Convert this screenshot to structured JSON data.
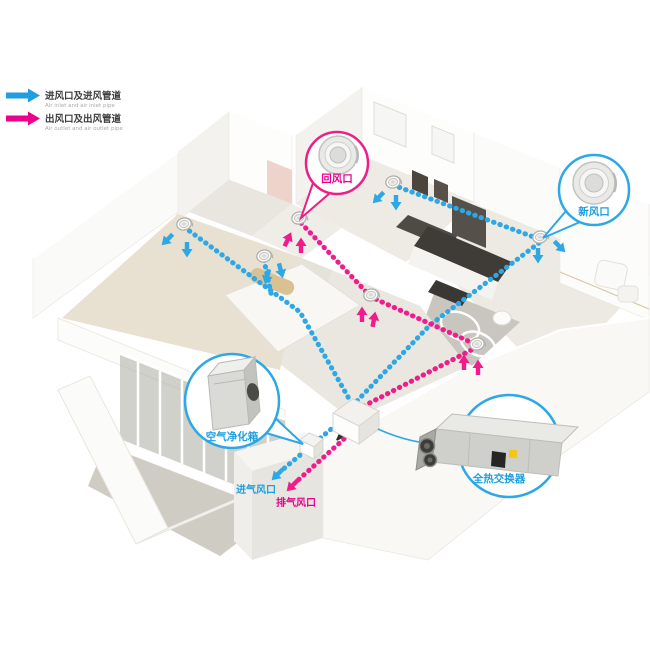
{
  "legend": {
    "inlet": {
      "cn": "进风口及进风管道",
      "en": "Air inlet and air inlet pipe"
    },
    "outlet": {
      "cn": "出风口及出风管道",
      "en": "Air outlet and air outlet pipe"
    }
  },
  "callouts": {
    "return_air": "回风口",
    "fresh_air": "新风口",
    "air_purifier": "空气净化箱",
    "heat_exchanger": "全热交换器"
  },
  "wall_vents": {
    "intake": "进气风口",
    "exhaust": "排气风口"
  },
  "colors": {
    "pipe_blue": "#2da7e5",
    "pipe_pink": "#ee1d8b",
    "label_blue": "#1e9fe0",
    "label_pink": "#ec008c"
  }
}
